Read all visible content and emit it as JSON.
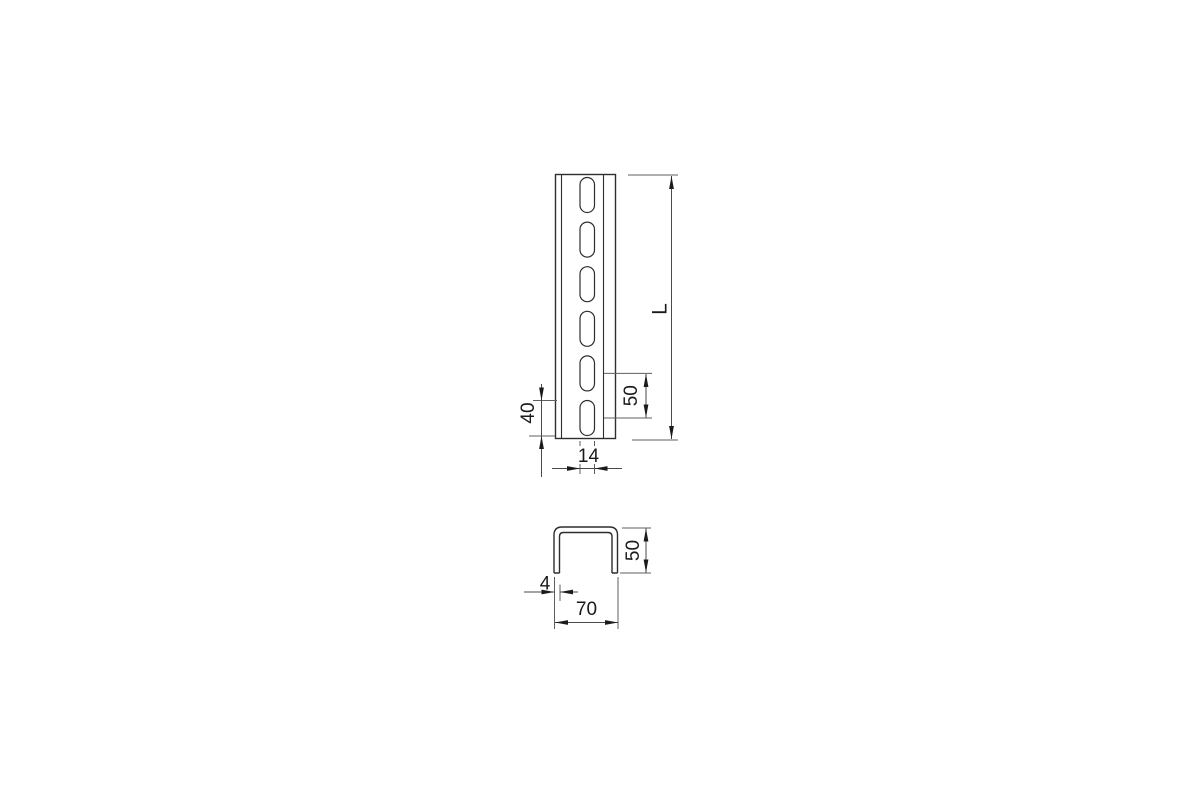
{
  "page": {
    "background": "#ffffff"
  },
  "drawing": {
    "kind": "technical-dimension-drawing",
    "subject": "perforated U-profile mounting channel",
    "colors": {
      "background": "#ffffff",
      "part_line": "#2e2e2e",
      "dimension_line": "#4a4a4a",
      "extension_line": "#5f5f5f",
      "arrow": "#1b1b1b",
      "label": "#1a1a1a"
    },
    "views": {
      "front": {
        "name": "front view (slotted face)",
        "slot_count": 6,
        "slot_shape": "oblong",
        "dimensions": [
          {
            "id": "length",
            "label": "L",
            "measures": "overall profile length",
            "orientation": "vertical"
          },
          {
            "id": "slot-pitch",
            "label": "50",
            "measures": "slot centre-to-centre pitch",
            "orientation": "vertical"
          },
          {
            "id": "slot-length",
            "label": "40",
            "measures": "oblong slot length",
            "orientation": "vertical"
          },
          {
            "id": "slot-width",
            "label": "14",
            "measures": "oblong slot width",
            "orientation": "horizontal"
          }
        ]
      },
      "section": {
        "name": "U cross-section",
        "dimensions": [
          {
            "id": "height",
            "label": "50",
            "measures": "profile height",
            "orientation": "vertical"
          },
          {
            "id": "thickness",
            "label": "4",
            "measures": "material thickness",
            "orientation": "horizontal"
          },
          {
            "id": "width",
            "label": "70",
            "measures": "profile outer width",
            "orientation": "horizontal"
          }
        ]
      }
    }
  }
}
